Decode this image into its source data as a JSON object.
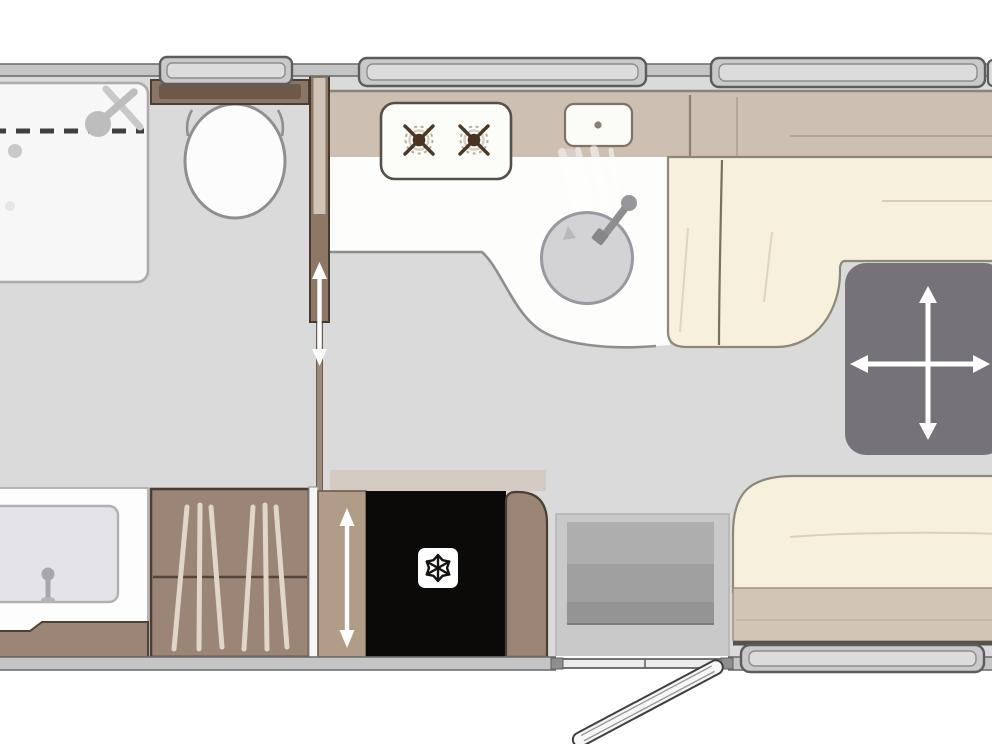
{
  "canvas": {
    "width": 992,
    "height": 744,
    "background": "#ffffff"
  },
  "palette": {
    "background": "#ffffff",
    "floor": "#dadada",
    "wall_fill": "#c5c5c5",
    "wall_stroke": "#6f6f6f",
    "counter_band": "#cdbfb1",
    "counter_edge": "#8b8176",
    "worktop_white": "#fdfdfc",
    "seat_cream": "#f6f0dd",
    "seat_outline": "#8d8878",
    "seat_base_tan": "#d2c5b6",
    "table_gray": "#757379",
    "wood_brown": "#9b8576",
    "wood_dark": "#4a3e33",
    "door_panel_brown": "#8d7866",
    "slide_strip_tan": "#b19c88",
    "fridge_black": "#0c0a08",
    "steps_outer": "#c9c9c9",
    "steps_inner": "#a3a3a3",
    "sink_gray": "#d3d3d6",
    "sink_rim": "#9899a0",
    "basin_gray": "#e4e4e8",
    "shower_tray": "#f7f7f7",
    "fixture_gray": "#bdbdbd",
    "cistern_brown": "#8b7566",
    "cistern_inner": "#6d594a",
    "window_frame_fill": "#c9c9c9",
    "window_frame_stroke": "#5c5c5c",
    "window_inner": "#dcdcdc",
    "threshold": "#ebebeb",
    "arrow_white": "#ffffff",
    "dash_dark": "#3f3f3f",
    "seam_light": "#d9d1bb",
    "clothes_streak": "#e0d7ca",
    "snowflake_badge": "#ffffff",
    "snowflake_glyph": "#151210"
  },
  "floorplan": {
    "type": "caravan-floorplan-top-view",
    "rooms": [
      {
        "name": "washroom",
        "fixtures": [
          "shower-tray",
          "shower-head",
          "toilet",
          "vanity-basin",
          "wardrobe",
          "sliding-door"
        ]
      },
      {
        "name": "kitchen",
        "fixtures": [
          "hob-two-burners",
          "drainer",
          "round-sink",
          "worktop"
        ]
      },
      {
        "name": "lounge-dinette",
        "fixtures": [
          "l-shaped-rear-seat",
          "sliding-table",
          "front-seat"
        ]
      },
      {
        "name": "entry",
        "fixtures": [
          "steps",
          "entry-door-open",
          "door-threshold"
        ]
      }
    ],
    "counts": {
      "hob_burners": 2,
      "windows_visible": 4,
      "toilets": 1,
      "sinks": 2
    },
    "annotations": [
      {
        "name": "table-move-arrows",
        "meaning": "table slides in four directions",
        "glyph": "four-way white arrow cross"
      },
      {
        "name": "bathroom-door-arrow",
        "meaning": "sliding door travel",
        "glyph": "vertical white double arrow"
      },
      {
        "name": "wardrobe-door-arrow",
        "meaning": "sliding front travel",
        "glyph": "vertical white double arrow"
      },
      {
        "name": "fridge-snowflake",
        "meaning": "refrigerator",
        "glyph": "snowflake in white rounded square"
      },
      {
        "name": "entry-door-leaf",
        "meaning": "entrance door shown open",
        "glyph": "angled door slab outside wall"
      }
    ]
  },
  "icons": [
    "shower-head-icon",
    "drain-icon",
    "tap-icon",
    "burner-cross-icon",
    "snowflake-icon",
    "double-arrow-icon",
    "four-way-arrow-icon",
    "clothes-hanging-icon"
  ]
}
